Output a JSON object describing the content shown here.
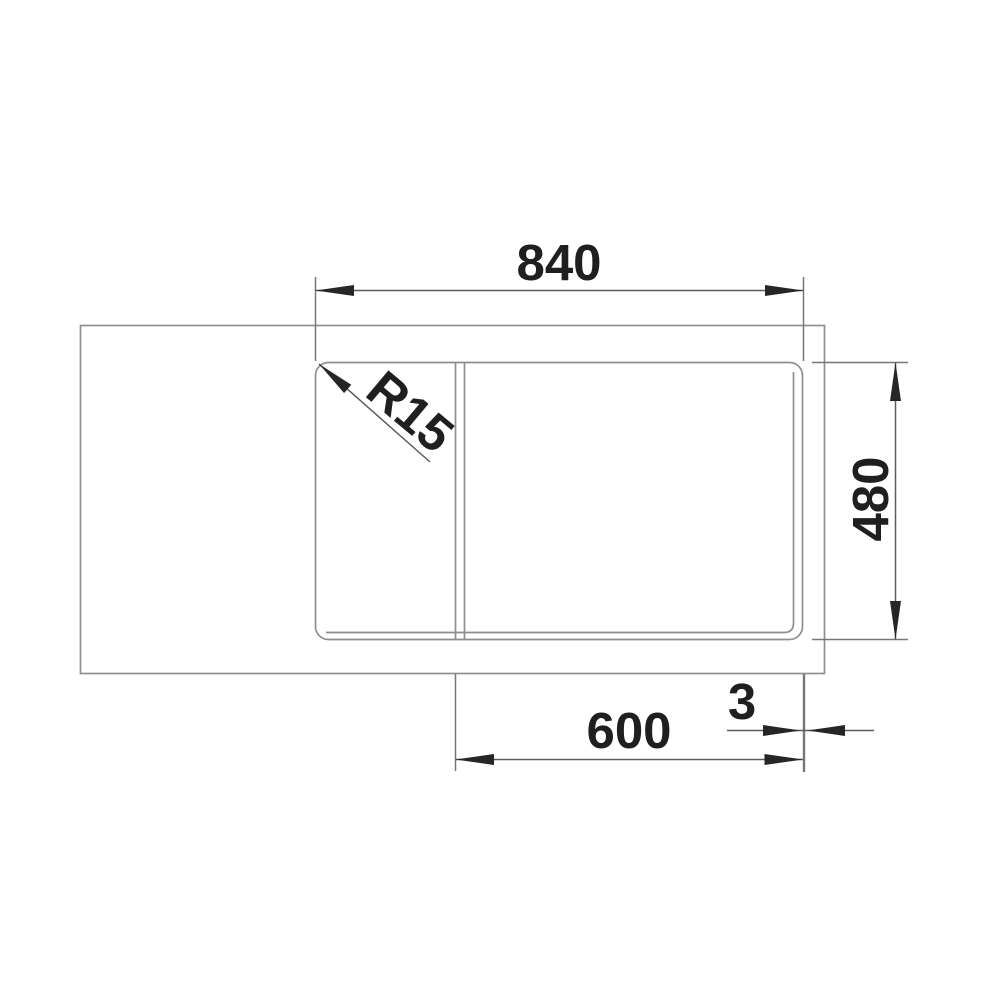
{
  "drawing": {
    "title": "sink-top-view-dimension-drawing",
    "labels": {
      "width": "840",
      "depth": "480",
      "cabinet_width": "600",
      "clearance": "3",
      "corner_radius": "R15"
    },
    "colors": {
      "background": "#ffffff",
      "outline": "#8f8f8f",
      "dimension_line": "#5d5d5d",
      "text": "#1f1f1f"
    }
  }
}
